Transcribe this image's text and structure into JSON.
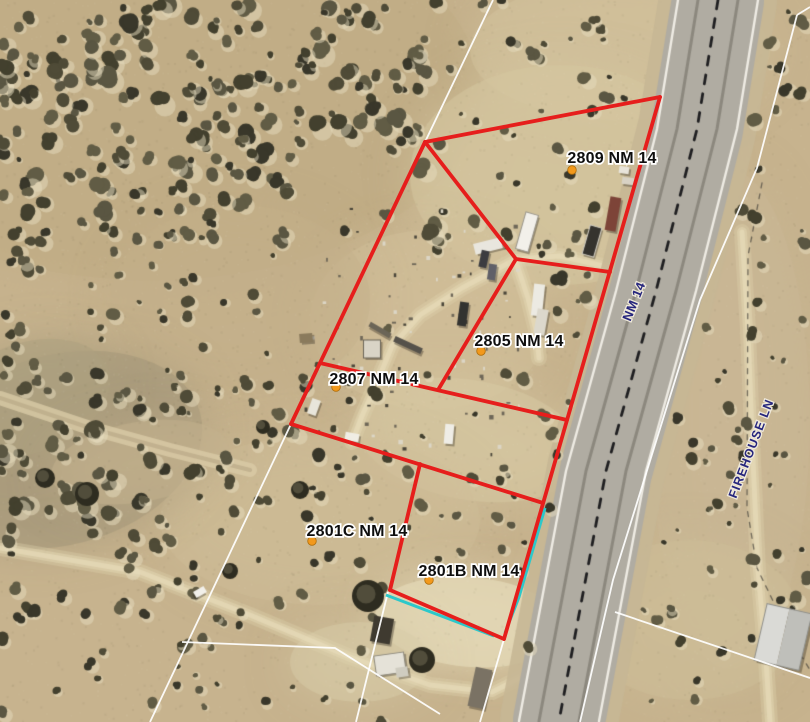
{
  "map": {
    "description": "aerial parcel map with selected lot boundaries",
    "colors": {
      "selected_boundary": "#e61e1c",
      "overlay_boundary": "#2cc8ca",
      "base_boundary": "#ffffff",
      "parcel_label_text": "#0e0e0e",
      "parcel_label_halo": "#ffffff",
      "road_label_text": "#26267d",
      "parcel_dot": "#f2991c"
    },
    "parcels": [
      {
        "id": "2809",
        "label": "2809 NM 14",
        "label_x": 612,
        "label_y": 163,
        "dot_x": 572,
        "dot_y": 170
      },
      {
        "id": "2805",
        "label": "2805 NM 14",
        "label_x": 519,
        "label_y": 346,
        "dot_x": 481,
        "dot_y": 351
      },
      {
        "id": "2807",
        "label": "2807 NM 14",
        "label_x": 374,
        "label_y": 384,
        "dot_x": 336,
        "dot_y": 387
      },
      {
        "id": "2801C",
        "label": "2801C NM 14",
        "label_x": 357,
        "label_y": 536,
        "dot_x": 312,
        "dot_y": 541
      },
      {
        "id": "2801B",
        "label": "2801B NM 14",
        "label_x": 469,
        "label_y": 576,
        "dot_x": 429,
        "dot_y": 580
      }
    ],
    "road_labels": [
      {
        "text": "NM 14",
        "x": 638,
        "y": 303,
        "rotation": -68,
        "size": 13
      },
      {
        "text": "FIREHOUSE LN",
        "x": 755,
        "y": 450,
        "rotation": -69,
        "size": 12.5
      }
    ],
    "selected_boundaries": [
      [
        [
          425,
          142
        ],
        [
          660,
          97
        ]
      ],
      [
        [
          660,
          97
        ],
        [
          504,
          639
        ]
      ],
      [
        [
          425,
          142
        ],
        [
          291,
          424
        ]
      ],
      [
        [
          425,
          142
        ],
        [
          516,
          259
        ]
      ],
      [
        [
          516,
          259
        ],
        [
          610,
          272
        ]
      ],
      [
        [
          516,
          259
        ],
        [
          438,
          390
        ]
      ],
      [
        [
          320,
          363
        ],
        [
          567,
          420
        ]
      ],
      [
        [
          291,
          424
        ],
        [
          543,
          503
        ]
      ],
      [
        [
          420,
          464
        ],
        [
          390,
          590
        ]
      ],
      [
        [
          390,
          590
        ],
        [
          504,
          639
        ]
      ]
    ],
    "overlay_boundaries": [
      [
        [
          545,
          508
        ],
        [
          519,
          597
        ],
        [
          505,
          633
        ]
      ],
      [
        [
          386,
          595
        ],
        [
          494,
          636
        ]
      ]
    ],
    "base_boundaries": [
      [
        [
          493,
          0
        ],
        [
          425,
          142
        ]
      ],
      [
        [
          291,
          424
        ],
        [
          150,
          722
        ]
      ],
      [
        [
          182,
          642
        ],
        [
          335,
          648
        ],
        [
          440,
          714
        ]
      ],
      [
        [
          504,
          639
        ],
        [
          480,
          722
        ]
      ],
      [
        [
          388,
          592
        ],
        [
          356,
          722
        ]
      ],
      [
        [
          797,
          15
        ],
        [
          757,
          168
        ],
        [
          700,
          300
        ],
        [
          613,
          580
        ],
        [
          580,
          722
        ]
      ],
      [
        [
          797,
          15
        ],
        [
          810,
          7
        ]
      ],
      [
        [
          615,
          612
        ],
        [
          810,
          678
        ]
      ]
    ]
  }
}
